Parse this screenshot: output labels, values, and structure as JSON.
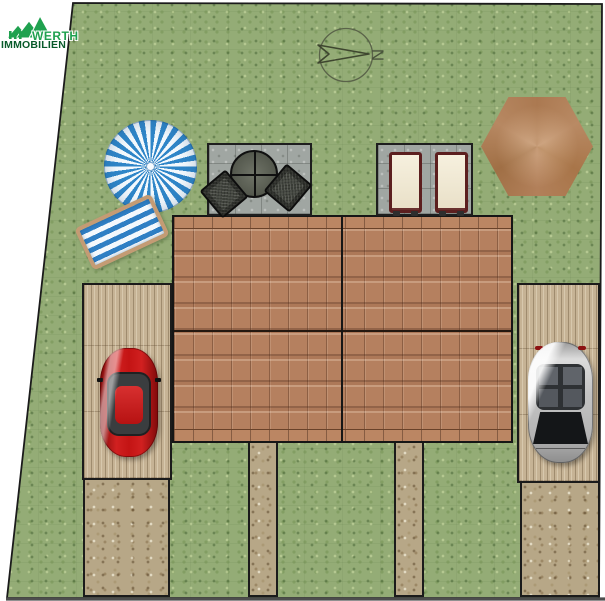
{
  "page": {
    "type": "residential-site-plan",
    "background": "#ffffff"
  },
  "logo": {
    "line1": "WERTH",
    "line2": "IMMOBILIEN",
    "icon": "triple-gable-roofs-icon",
    "green": "#1fa14f",
    "dark_green": "#085a2a"
  },
  "compass": {
    "label": "N",
    "points": "right"
  },
  "boundary": {
    "color": "#1b1b1b",
    "shape": "irregular-quadrilateral"
  },
  "ground": {
    "grass": "#94ac76",
    "gravel": "#b7a787",
    "decking": "#c6b395",
    "terrace": "#a0a6a2"
  },
  "building": {
    "name": "semi-detached-house-roof",
    "tile_color": "#b5805f",
    "units": 2,
    "ridge": "horizontal-center"
  },
  "objects": [
    {
      "name": "blue-parasol",
      "colors": [
        "#2f86c8",
        "#f3f9fd"
      ]
    },
    {
      "name": "striped-sun-lounger",
      "colors": [
        "#2f7fc4",
        "#f4f8fc",
        "#c49b74"
      ]
    },
    {
      "name": "terrace-left",
      "furniture": [
        "round-table",
        "chair",
        "chair"
      ]
    },
    {
      "name": "terrace-right",
      "furniture": [
        "cushion-lounger",
        "cushion-lounger"
      ]
    },
    {
      "name": "brown-parasol",
      "colors": [
        "#b2805a"
      ]
    },
    {
      "name": "red-car",
      "colors": [
        "#c31414"
      ]
    },
    {
      "name": "silver-car",
      "colors": [
        "#c4c4c4"
      ]
    },
    {
      "name": "carport-left"
    },
    {
      "name": "carport-right"
    },
    {
      "name": "driveway-left"
    },
    {
      "name": "driveway-right"
    },
    {
      "name": "garden-path-left"
    },
    {
      "name": "garden-path-right"
    }
  ]
}
